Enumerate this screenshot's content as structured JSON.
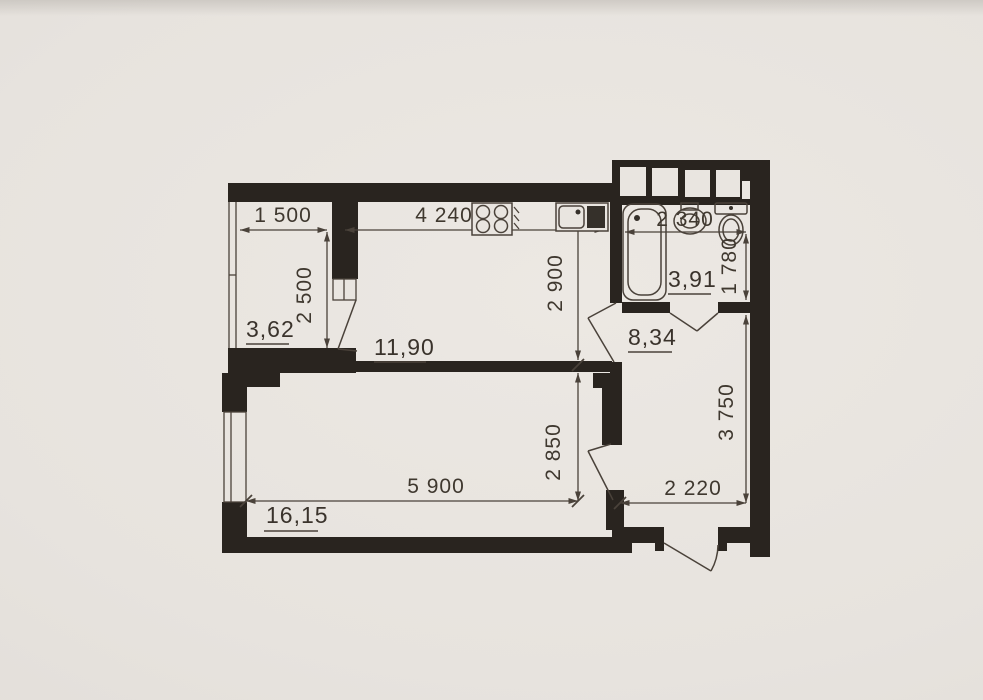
{
  "document": {
    "kind": "scanned apartment floor plan"
  },
  "palette": {
    "paper": "#e7e3de",
    "wall_ink": "#29241f",
    "line_ink": "#4a423a",
    "text_ink": "#3a332c"
  },
  "rooms": {
    "balcony": {
      "area": "3,62",
      "width_mm": "1 500",
      "depth_mm": "2 500"
    },
    "kitchen": {
      "area": "11,90",
      "width_mm": "4 240",
      "depth_mm": "2 900"
    },
    "bathroom": {
      "area": "3,91",
      "width_mm": "2 340",
      "depth_mm": "1 780"
    },
    "hallway": {
      "area": "8,34",
      "width_mm": "2 220",
      "depth_mm": "3 750"
    },
    "living_room": {
      "area": "16,15",
      "width_mm": "5 900",
      "depth_mm": "2 850"
    }
  },
  "fixtures": {
    "bathtub": "bathtub",
    "washbasin": "washbasin",
    "toilet": "toilet",
    "stove": "stove-burners",
    "sink": "kitchen-sink",
    "vents": "ventilation-shafts"
  }
}
